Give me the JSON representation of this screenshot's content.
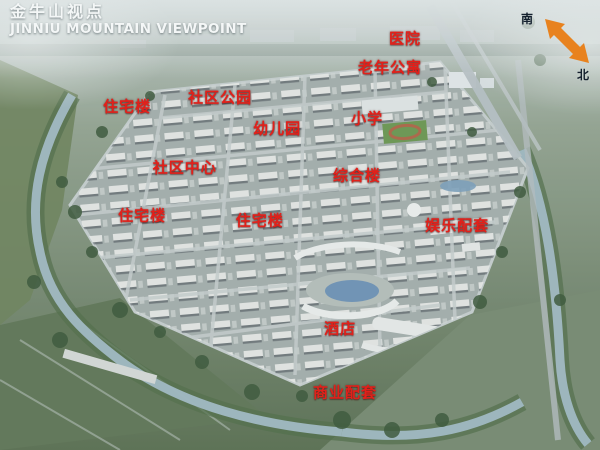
{
  "header": {
    "title_zh": "金牛山视点",
    "title_en": "JINNIU MOUNTAIN VIEWPOINT"
  },
  "compass": {
    "south": "南",
    "north": "北"
  },
  "map_labels": [
    {
      "id": "hospital",
      "text": "医院"
    },
    {
      "id": "senior-apartments",
      "text": "老年公寓"
    },
    {
      "id": "residential-building-1",
      "text": "住宅楼"
    },
    {
      "id": "community-park",
      "text": "社区公园"
    },
    {
      "id": "kindergarten",
      "text": "幼儿园"
    },
    {
      "id": "primary-school",
      "text": "小学"
    },
    {
      "id": "community-center",
      "text": "社区中心"
    },
    {
      "id": "complex-building",
      "text": "综合楼"
    },
    {
      "id": "residential-building-2",
      "text": "住宅楼"
    },
    {
      "id": "residential-building-3",
      "text": "住宅楼"
    },
    {
      "id": "entertainment-amenities",
      "text": "娱乐配套"
    },
    {
      "id": "hotel",
      "text": "酒店"
    },
    {
      "id": "commercial-amenities",
      "text": "商业配套"
    }
  ],
  "colors": {
    "label_red": "#e2201a",
    "title_white": "#f4f7f7",
    "arrow_orange": "#e8821e",
    "compass_text": "#14202e"
  }
}
